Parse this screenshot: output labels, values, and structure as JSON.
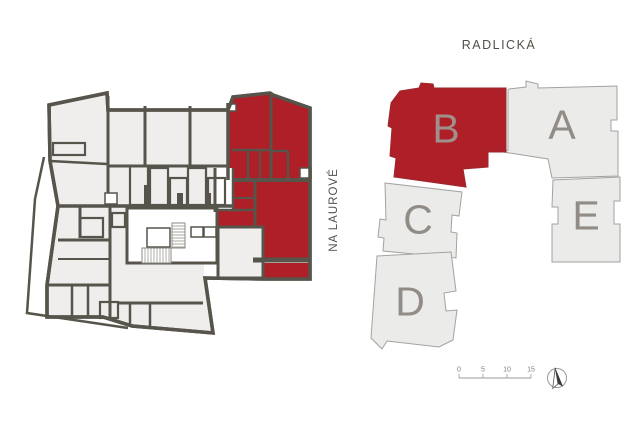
{
  "colors": {
    "highlight": "#ae1f27",
    "wall": "#57544b",
    "room_fill": "#efeeec",
    "site_fill": "#ebebea",
    "site_stroke": "#a3a2a0",
    "label_gray": "#918c85",
    "label_gray_on_red": "#a0908b",
    "text_dark": "#53504a",
    "scale_gray": "#7d7d7b"
  },
  "streets": {
    "top": "RADLICKÁ",
    "right": "NA LAUROVÉ"
  },
  "site_plan": {
    "buildings": [
      {
        "id": "A",
        "label": "A",
        "highlighted": false
      },
      {
        "id": "B",
        "label": "B",
        "highlighted": true
      },
      {
        "id": "C",
        "label": "C",
        "highlighted": false
      },
      {
        "id": "D",
        "label": "D",
        "highlighted": false
      },
      {
        "id": "E",
        "label": "E",
        "highlighted": false
      }
    ],
    "scale_bar": {
      "labels": [
        "0",
        "5",
        "10",
        "15"
      ]
    },
    "icons": {
      "north_arrow": "north-arrow-compass"
    }
  },
  "floor_plan": {
    "highlighted_building": "B"
  }
}
